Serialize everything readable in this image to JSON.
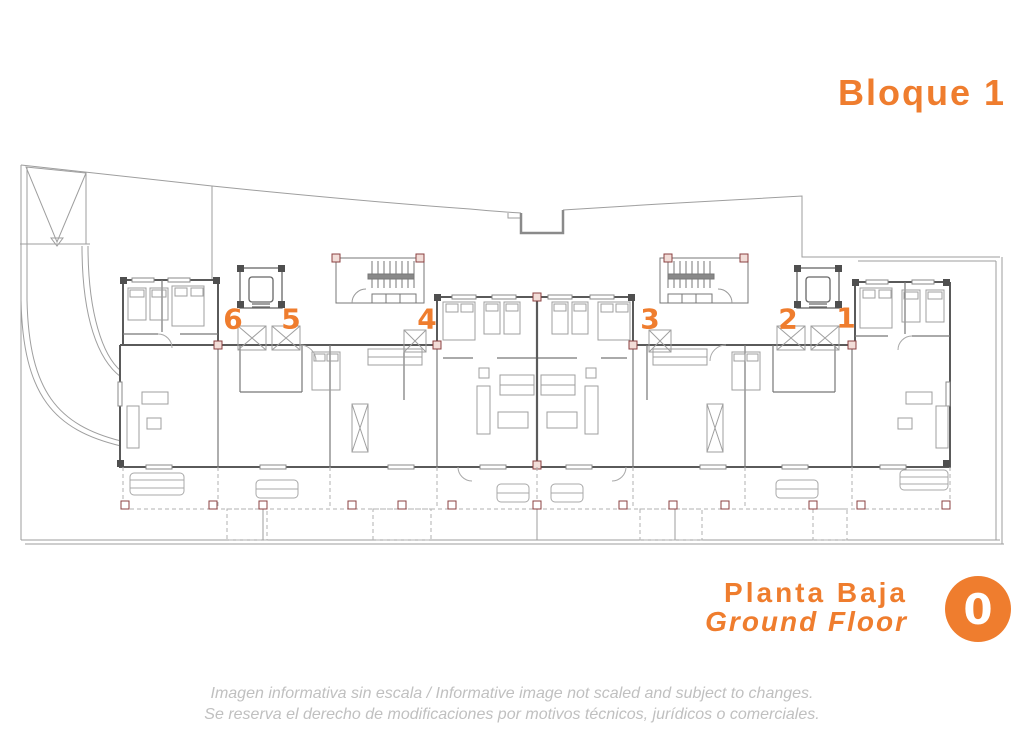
{
  "header": {
    "block_title": "Bloque 1",
    "accent_color": "#EF7D2E"
  },
  "plan": {
    "apartment_labels": [
      "6",
      "5",
      "4",
      "3",
      "2",
      "1"
    ]
  },
  "floor": {
    "title_es": "Planta Baja",
    "title_en": "Ground Floor",
    "number": "0"
  },
  "footer": {
    "line1": "Imagen informativa sin escala /  Informative image not scaled and subject to changes.",
    "line2": "Se reserva el derecho de modificaciones por motivos técnicos, jurídicos o comerciales."
  }
}
